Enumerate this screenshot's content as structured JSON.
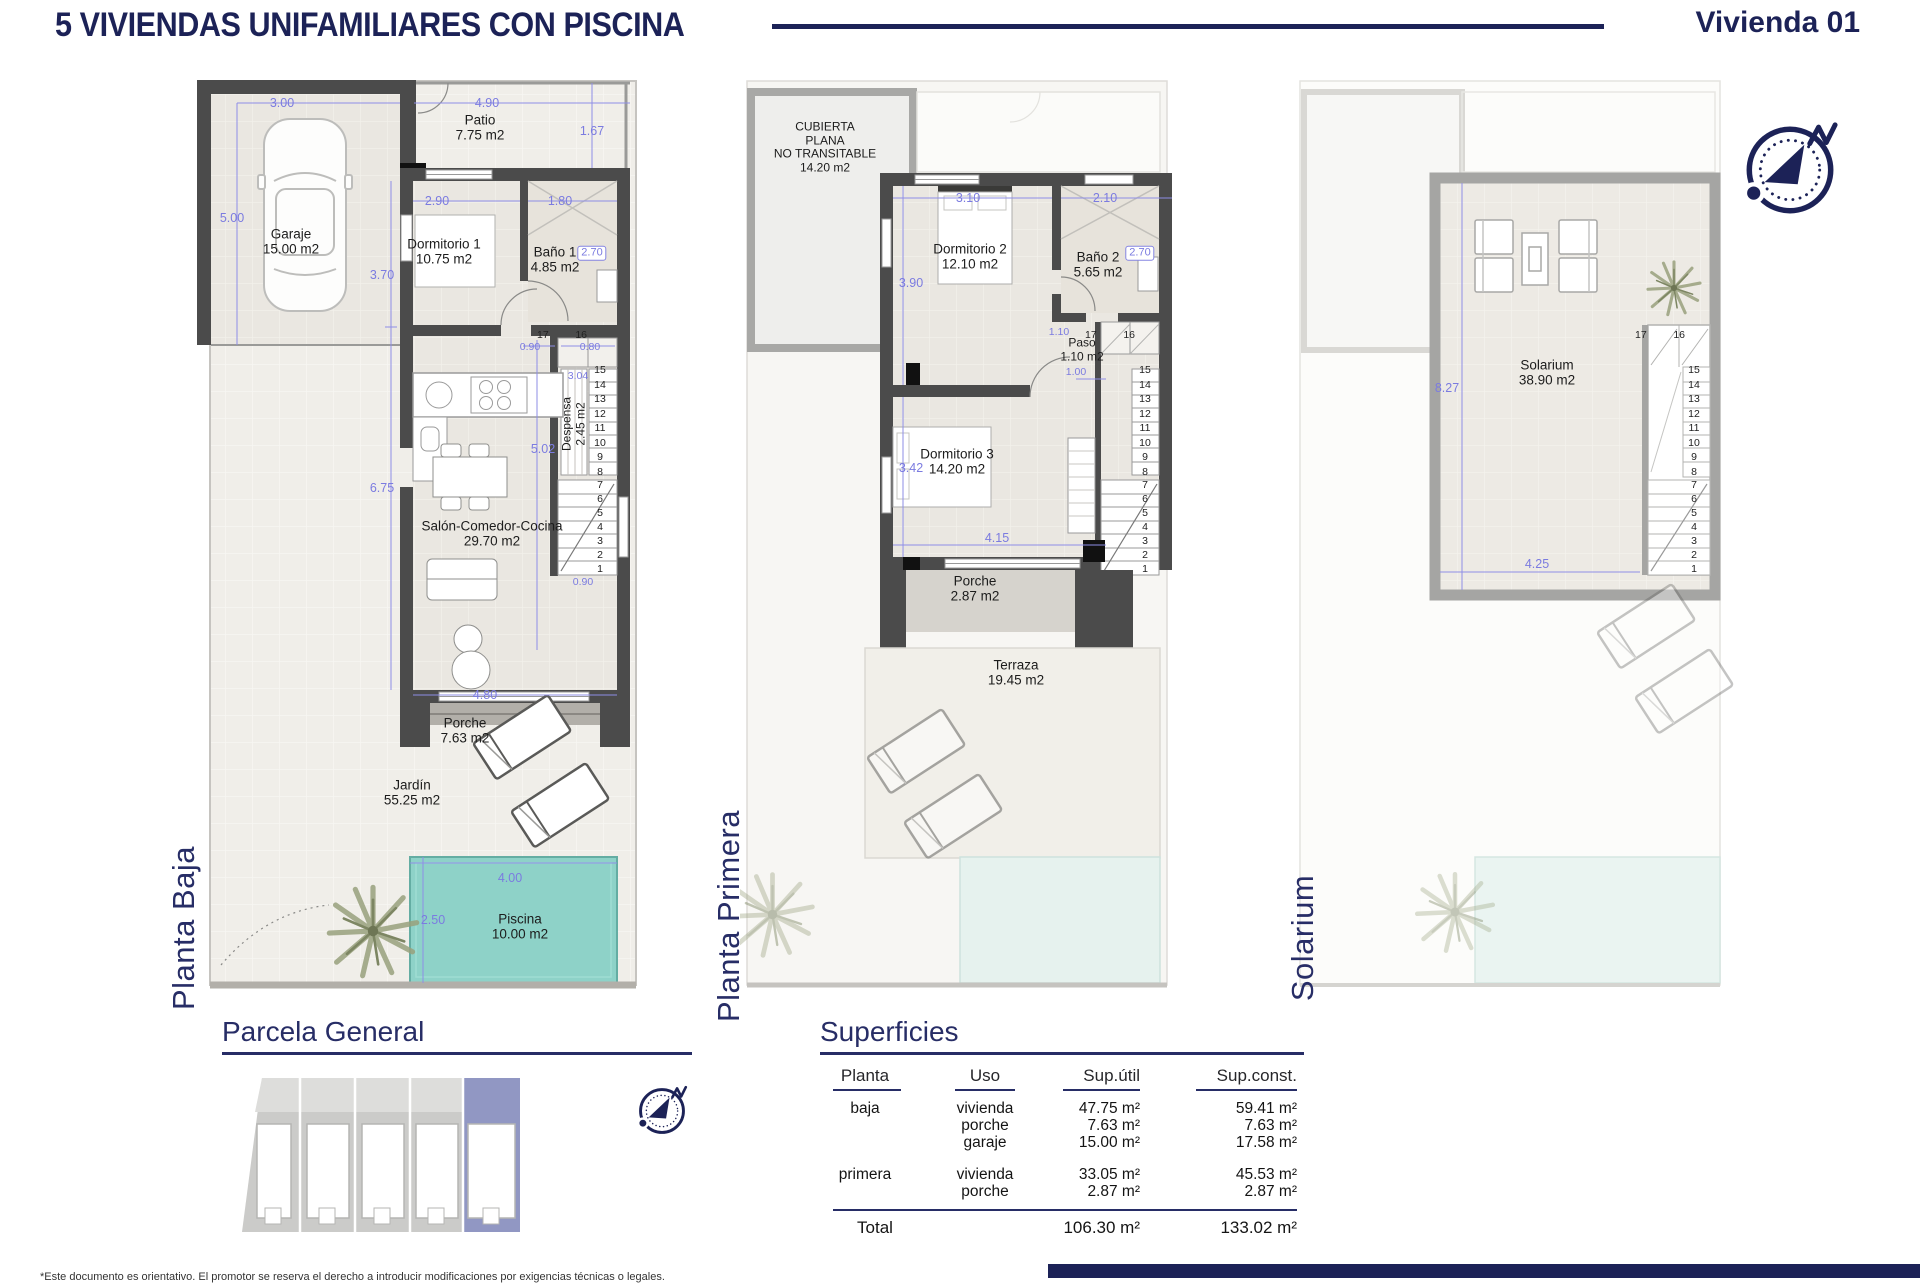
{
  "header": {
    "title": "5 VIVIENDAS UNIFAMILIARES CON PISCINA",
    "unit": "Vivienda 01"
  },
  "planta_baja": {
    "label": "Planta Baja",
    "rooms": {
      "patio": "Patio\n7.75 m2",
      "garaje": "Garaje\n15.00 m2",
      "dormitorio1": "Dormitorio 1\n10.75 m2",
      "bano1": "Baño 1\n4.85 m2",
      "despensa": "Despensa\n2.45 m2",
      "salon": "Salón-Comedor-Cocina\n29.70 m2",
      "porche": "Porche\n7.63 m2",
      "jardin": "Jardín\n55.25 m2",
      "piscina": "Piscina\n10.00 m2"
    },
    "dims": {
      "w_garaje": "3.00",
      "w_patio": "4.90",
      "h_garaje": "5.00",
      "h_patio": "1.67",
      "w_dormitorio1": "2.90",
      "w_bano1": "1.80",
      "h_bano1": "2.70",
      "h_dormitorio1": "3.70",
      "door_a": "0.90",
      "door_b": "0.80",
      "h_despensa": "3.04",
      "h_stairs": "5.02",
      "h_salon": "6.75",
      "door_salon": "0.90",
      "w_salon": "4.80",
      "w_piscina": "4.00",
      "h_piscina": "2.50"
    },
    "stairs_top": [
      "17",
      "16"
    ],
    "stairs_upper": [
      "15",
      "14",
      "13",
      "12",
      "11",
      "10",
      "9",
      "8"
    ],
    "stairs_lower": [
      "7",
      "6",
      "5",
      "4",
      "3",
      "2",
      "1"
    ]
  },
  "planta_primera": {
    "label": "Planta Primera",
    "rooms": {
      "cubierta": "CUBIERTA\nPLANA\nNO TRANSITABLE\n14.20 m2",
      "dormitorio2": "Dormitorio 2\n12.10 m2",
      "bano2": "Baño 2\n5.65 m2",
      "paso": "Paso\n1.10 m2",
      "dormitorio3": "Dormitorio 3\n14.20 m2",
      "porche": "Porche\n2.87 m2",
      "terraza": "Terraza\n19.45 m2"
    },
    "dims": {
      "w_dormitorio2": "3.10",
      "w_bano2": "2.10",
      "h_dormitorio2": "3.90",
      "h_bano2": "2.70",
      "h_paso": "1.10",
      "door_paso": "1.00",
      "h_dormitorio3": "3.42",
      "w_dormitorio3": "4.15"
    },
    "stairs_top": [
      "17",
      "16"
    ],
    "stairs_upper": [
      "15",
      "14",
      "13",
      "12",
      "11",
      "10",
      "9",
      "8"
    ],
    "stairs_lower": [
      "7",
      "6",
      "5",
      "4",
      "3",
      "2",
      "1"
    ]
  },
  "solarium": {
    "label": "Solarium",
    "rooms": {
      "solarium": "Solarium\n38.90 m2"
    },
    "dims": {
      "h_solarium": "8.27",
      "w_stairs": "4.25"
    },
    "stairs_top": [
      "17",
      "16"
    ],
    "stairs_upper": [
      "15",
      "14",
      "13",
      "12",
      "11",
      "10",
      "9",
      "8"
    ],
    "stairs_lower": [
      "7",
      "6",
      "5",
      "4",
      "3",
      "2",
      "1"
    ]
  },
  "parcela": {
    "heading": "Parcela General",
    "plots": [
      "05",
      "04",
      "03",
      "02",
      "01"
    ],
    "highlighted_plot": "01"
  },
  "superficies": {
    "heading": "Superficies",
    "columns": [
      "Planta",
      "Uso",
      "Sup.útil",
      "Sup.const."
    ],
    "rows": [
      {
        "planta": "baja",
        "uso": "vivienda",
        "util": "47.75 m²",
        "const": "59.41 m²"
      },
      {
        "planta": "",
        "uso": "porche",
        "util": "7.63 m²",
        "const": "7.63 m²"
      },
      {
        "planta": "",
        "uso": "garaje",
        "util": "15.00 m²",
        "const": "17.58 m²"
      },
      {
        "planta": "primera",
        "uso": "vivienda",
        "util": "33.05 m²",
        "const": "45.53 m²"
      },
      {
        "planta": "",
        "uso": "porche",
        "util": "2.87 m²",
        "const": "2.87 m²"
      }
    ],
    "total": {
      "label": "Total",
      "util": "106.30 m²",
      "const": "133.02 m²"
    }
  },
  "footer": {
    "disclaimer": "*Este documento es orientativo. El promotor se reserva el derecho a introducir modificaciones por exigencias técnicas o legales."
  },
  "colors": {
    "navy": "#1c2257",
    "dim_blue": "#7b7be0",
    "pool": "#8ed2c8",
    "plot_highlight": "#9197c3"
  }
}
